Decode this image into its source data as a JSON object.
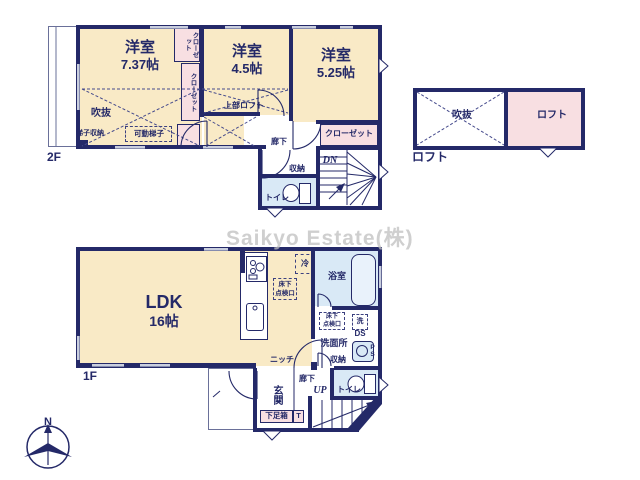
{
  "watermark": "Saikyo Estate(株)",
  "compass": {
    "north_label": "N"
  },
  "floor2": {
    "floor_label": "2F",
    "room_737": {
      "name": "洋室",
      "size": "7.37帖"
    },
    "room_45": {
      "name": "洋室",
      "size": "4.5帖"
    },
    "room_525": {
      "name": "洋室",
      "size": "5.25帖"
    },
    "closet_top": "クローゼット",
    "closet_mid": "クローゼット",
    "closet_525": "クローゼット",
    "void": "吹抜",
    "ladder_storage": "梯子収納",
    "movable_ladder": "可動梯子",
    "upper_loft": "上部ロフト",
    "hallway": "廊下",
    "storage": "収納",
    "toilet": "トイレ",
    "stairs_down": "DN"
  },
  "loft": {
    "caption": "ロフト",
    "void": "吹抜",
    "room": "ロフト"
  },
  "floor1": {
    "floor_label": "1F",
    "ldk": {
      "name": "LDK",
      "size": "16帖"
    },
    "fridge": "冷",
    "floor_hatch": {
      "line1": "床下",
      "line2": "点検口"
    },
    "bathroom": "浴室",
    "washer": "洗",
    "duct_space": "DS",
    "washroom": "洗面所",
    "storage": "収納",
    "pipe_space": "PS",
    "niche": "ニッチ",
    "entrance": "玄関",
    "hallway": "廊下",
    "stairs_up": "UP",
    "toilet": "トイレ",
    "shoe_box": "下足箱",
    "shoe_box_mark": "T"
  }
}
